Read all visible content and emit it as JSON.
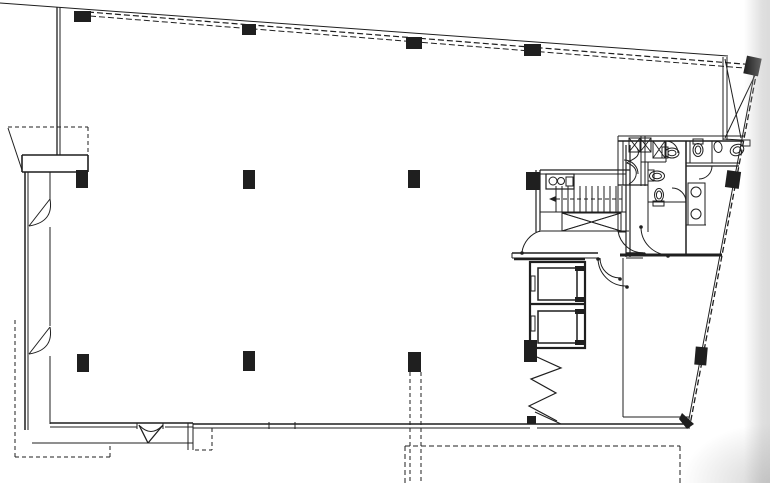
{
  "meta": {
    "document_type": "architectural-floor-plan",
    "visible_text": []
  },
  "plan": {
    "canvas": {
      "w": 770,
      "h": 483
    },
    "colors": {
      "ink": "#1f1f1f",
      "paper": "#ffffff",
      "scan_edge": "#bdbdbd"
    },
    "walls": [
      [
        0,
        3,
        728,
        56,
        1
      ],
      [
        57,
        7,
        57,
        155,
        1.3
      ],
      [
        60,
        7,
        60,
        155,
        1
      ],
      [
        22,
        155,
        88,
        155,
        1.6
      ],
      [
        22,
        172,
        88,
        172,
        1.6
      ],
      [
        22,
        155,
        22,
        172,
        1.6
      ],
      [
        88,
        155,
        88,
        172,
        1.6
      ],
      [
        8,
        128,
        22,
        170,
        1
      ],
      [
        25,
        172,
        25,
        430,
        1.5
      ],
      [
        28,
        172,
        28,
        430,
        1
      ],
      [
        50,
        172,
        50,
        199,
        1
      ],
      [
        50,
        227,
        50,
        326,
        1
      ],
      [
        50,
        356,
        50,
        424,
        1
      ],
      [
        50,
        199,
        29,
        226,
        1
      ],
      [
        50,
        327,
        29,
        354,
        1
      ],
      [
        50,
        423,
        193,
        423,
        1.6
      ],
      [
        50,
        427,
        137,
        427,
        1
      ],
      [
        165,
        427,
        193,
        427,
        1
      ],
      [
        32,
        443,
        193,
        443,
        1
      ],
      [
        188,
        423,
        188,
        450,
        1
      ],
      [
        193,
        423,
        193,
        450,
        1
      ],
      [
        137,
        423,
        137,
        429,
        1
      ],
      [
        163,
        423,
        163,
        429,
        1
      ],
      [
        139,
        425,
        148,
        443,
        1.3
      ],
      [
        148,
        443,
        163,
        425,
        1.3
      ],
      [
        193,
        424,
        690,
        424,
        1.6
      ],
      [
        193,
        428,
        530,
        428,
        1
      ],
      [
        537,
        428,
        690,
        428,
        1
      ],
      [
        269,
        422,
        269,
        429,
        1
      ],
      [
        295,
        422,
        295,
        429,
        1
      ],
      [
        535,
        412,
        561,
        424,
        1
      ],
      [
        755,
        70,
        688,
        424,
        1
      ],
      [
        723,
        57,
        723,
        140,
        1
      ],
      [
        727,
        57,
        727,
        140,
        1
      ],
      [
        723,
        139,
        741,
        140,
        1
      ],
      [
        725,
        59,
        741,
        138,
        1
      ],
      [
        725,
        138,
        757,
        71,
        1
      ],
      [
        536,
        170,
        536,
        232,
        1.2
      ],
      [
        540,
        170,
        540,
        232,
        1.2
      ],
      [
        540,
        170,
        630,
        170,
        1.3
      ],
      [
        540,
        174,
        626,
        174,
        1
      ],
      [
        626,
        145,
        626,
        257,
        1.2
      ],
      [
        630,
        145,
        630,
        257,
        1.2
      ],
      [
        541,
        231,
        629,
        231,
        1
      ],
      [
        540,
        212,
        626,
        212,
        1
      ],
      [
        562,
        213,
        621,
        231,
        1
      ],
      [
        562,
        231,
        621,
        213,
        1
      ],
      [
        512,
        253,
        598,
        253,
        1.4
      ],
      [
        512,
        258,
        598,
        258,
        1
      ],
      [
        512,
        253,
        512,
        258,
        1
      ],
      [
        626,
        253,
        643,
        253,
        1.4
      ],
      [
        626,
        258,
        643,
        258,
        1
      ],
      [
        514,
        259,
        585,
        259,
        2.6
      ],
      [
        530,
        304,
        585,
        304,
        2.2
      ],
      [
        623,
        258,
        623,
        417,
        1
      ],
      [
        620,
        255,
        722,
        255,
        3
      ],
      [
        623,
        417,
        689,
        417,
        1
      ],
      [
        618,
        136,
        744,
        136,
        1
      ],
      [
        618,
        141,
        743,
        141,
        1.5
      ],
      [
        618,
        136,
        618,
        232,
        1
      ],
      [
        623,
        141,
        623,
        185,
        1
      ],
      [
        641,
        136,
        641,
        186,
        1
      ],
      [
        645,
        136,
        645,
        186,
        1
      ],
      [
        618,
        185,
        648,
        185,
        1.3
      ],
      [
        666,
        141,
        666,
        162,
        1
      ],
      [
        641,
        162,
        666,
        162,
        1
      ],
      [
        686,
        141,
        686,
        255,
        1.5
      ],
      [
        686,
        163,
        740,
        163,
        1
      ],
      [
        686,
        166,
        739,
        166,
        1.3
      ],
      [
        712,
        141,
        712,
        163,
        1
      ],
      [
        690,
        141,
        690,
        163,
        1
      ],
      [
        648,
        162,
        648,
        202,
        1
      ],
      [
        648,
        202,
        686,
        202,
        1
      ],
      [
        648,
        202,
        648,
        232,
        1
      ],
      [
        618,
        232,
        626,
        232,
        1
      ],
      [
        686,
        225,
        706,
        225,
        1
      ]
    ],
    "dashed": [
      [
        88,
        12,
        756,
        65,
        1.2,
        "6,3"
      ],
      [
        90,
        16,
        757,
        69,
        1,
        "6,3"
      ],
      [
        757,
        70,
        690,
        425,
        1.3,
        "6,3"
      ],
      [
        8,
        127,
        88,
        127,
        1,
        "4,3"
      ],
      [
        88,
        127,
        88,
        154,
        1,
        "4,3"
      ],
      [
        15,
        320,
        15,
        457,
        1,
        "4,3"
      ],
      [
        15,
        457,
        110,
        457,
        1,
        "4,3"
      ],
      [
        110,
        457,
        110,
        443,
        1,
        "4,3"
      ],
      [
        195,
        450,
        212,
        450,
        1,
        "4,3"
      ],
      [
        212,
        428,
        212,
        450,
        1,
        "4,3"
      ],
      [
        405,
        446,
        680,
        446,
        1,
        "5,3"
      ],
      [
        405,
        446,
        405,
        483,
        1,
        "5,3"
      ],
      [
        680,
        446,
        680,
        483,
        1,
        "5,3"
      ],
      [
        410,
        372,
        410,
        483,
        1,
        "4,3"
      ],
      [
        421,
        372,
        421,
        483,
        1,
        "4,3"
      ],
      [
        556,
        199,
        622,
        199,
        1,
        "4,3"
      ]
    ],
    "columns": [
      [
        74,
        11,
        17,
        11,
        0
      ],
      [
        242,
        24,
        14,
        11,
        0
      ],
      [
        406,
        37,
        16,
        12,
        0
      ],
      [
        524,
        44,
        17,
        12,
        0
      ],
      [
        745,
        57,
        15,
        18,
        12
      ],
      [
        76,
        170,
        12,
        18,
        0
      ],
      [
        243,
        170,
        12,
        19,
        0
      ],
      [
        408,
        170,
        12,
        18,
        0
      ],
      [
        526,
        172,
        14,
        18,
        0
      ],
      [
        726,
        171,
        14,
        17,
        8
      ],
      [
        77,
        354,
        12,
        18,
        0
      ],
      [
        243,
        351,
        12,
        20,
        0
      ],
      [
        408,
        352,
        13,
        20,
        0
      ],
      [
        524,
        340,
        13,
        22,
        0
      ],
      [
        695,
        347,
        12,
        18,
        5
      ],
      [
        527,
        416,
        9,
        8,
        0
      ]
    ],
    "rects": [
      [
        530,
        262,
        55,
        86,
        2.2
      ],
      [
        538,
        268,
        39,
        32,
        1.5
      ],
      [
        538,
        311,
        39,
        32,
        1.5
      ],
      [
        531,
        276,
        4,
        15,
        1
      ],
      [
        531,
        316,
        4,
        15,
        1
      ],
      [
        546,
        174,
        28,
        15,
        1.2
      ],
      [
        566,
        177,
        7,
        9,
        1
      ],
      [
        688,
        183,
        17,
        42,
        1
      ],
      [
        662,
        147,
        6,
        11,
        1
      ],
      [
        693,
        139,
        10,
        5,
        1
      ],
      [
        741,
        140,
        9,
        6,
        1
      ],
      [
        648,
        170,
        6,
        11,
        1
      ],
      [
        653,
        201,
        11,
        5,
        1
      ]
    ],
    "fill_rects": [
      [
        575,
        266,
        9,
        5
      ],
      [
        575,
        297,
        9,
        5
      ],
      [
        575,
        309,
        9,
        5
      ],
      [
        575,
        340,
        9,
        5
      ]
    ],
    "x_boxes": [
      [
        629,
        138,
        11,
        14
      ],
      [
        640,
        138,
        11,
        14
      ],
      [
        653,
        141,
        12,
        17
      ],
      [
        562,
        213,
        59,
        18
      ]
    ],
    "arcs": [
      "M50,199 Q54,222 29,226",
      "M50,327 Q54,350 29,354",
      "M140,426 Q151,437 162,426",
      "M522,252 A26,26 0 0 1 540,231",
      "M618,231 A26,26 0 0 0 644,253",
      "M598,258 A28,28 0 0 0 626,286",
      "M600,258 A20,20 0 0 0 620,278",
      "M668,255 A28,28 0 0 1 641,227",
      "M666,141 A12,12 0 0 1 678,153",
      "M686,202 A14,14 0 0 0 672,188",
      "M712,166 A13,13 0 0 1 699,179",
      "M637,148 C643,158 629,160 627,163 C641,168 637,180 629,184",
      "M624,160 A14,14 0 0 1 638,174"
    ],
    "polylines": [
      [
        [
          537,
          357
        ],
        [
          561,
          368
        ],
        [
          531,
          379
        ],
        [
          556,
          393
        ],
        [
          529,
          406
        ],
        [
          557,
          421
        ]
      ]
    ],
    "treads": {
      "x1": 556,
      "x2": 626,
      "y1": 186,
      "y2": 212,
      "step": 6
    },
    "ellipses": [
      [
        672,
        153,
        7,
        5,
        0
      ],
      [
        672,
        153,
        4,
        2.8,
        0
      ],
      [
        698,
        150,
        5,
        6.5,
        0
      ],
      [
        698,
        150,
        2.8,
        4,
        0
      ],
      [
        737,
        150,
        7,
        5.5,
        -25
      ],
      [
        737,
        150,
        4,
        3,
        -25
      ],
      [
        657,
        176,
        7.5,
        5,
        0
      ],
      [
        657,
        176,
        4.5,
        2.8,
        0
      ],
      [
        659,
        195,
        4.5,
        6.5,
        0
      ],
      [
        659,
        195,
        2.6,
        4,
        0
      ],
      [
        718,
        147,
        4,
        5.5,
        -10
      ]
    ],
    "circles": [
      [
        696,
        192,
        5
      ],
      [
        696,
        214,
        5
      ],
      [
        553,
        181,
        4
      ],
      [
        561,
        181,
        3.5
      ]
    ],
    "dots": [
      [
        522,
        253
      ],
      [
        644,
        254
      ],
      [
        627,
        287
      ],
      [
        641,
        227
      ],
      [
        668,
        256
      ],
      [
        598,
        259
      ],
      [
        620,
        279
      ]
    ],
    "fills": [
      "M682,413 L694,424 L687,429 L679,419 Z",
      "M556,196 L549,199 L556,202 Z"
    ]
  }
}
